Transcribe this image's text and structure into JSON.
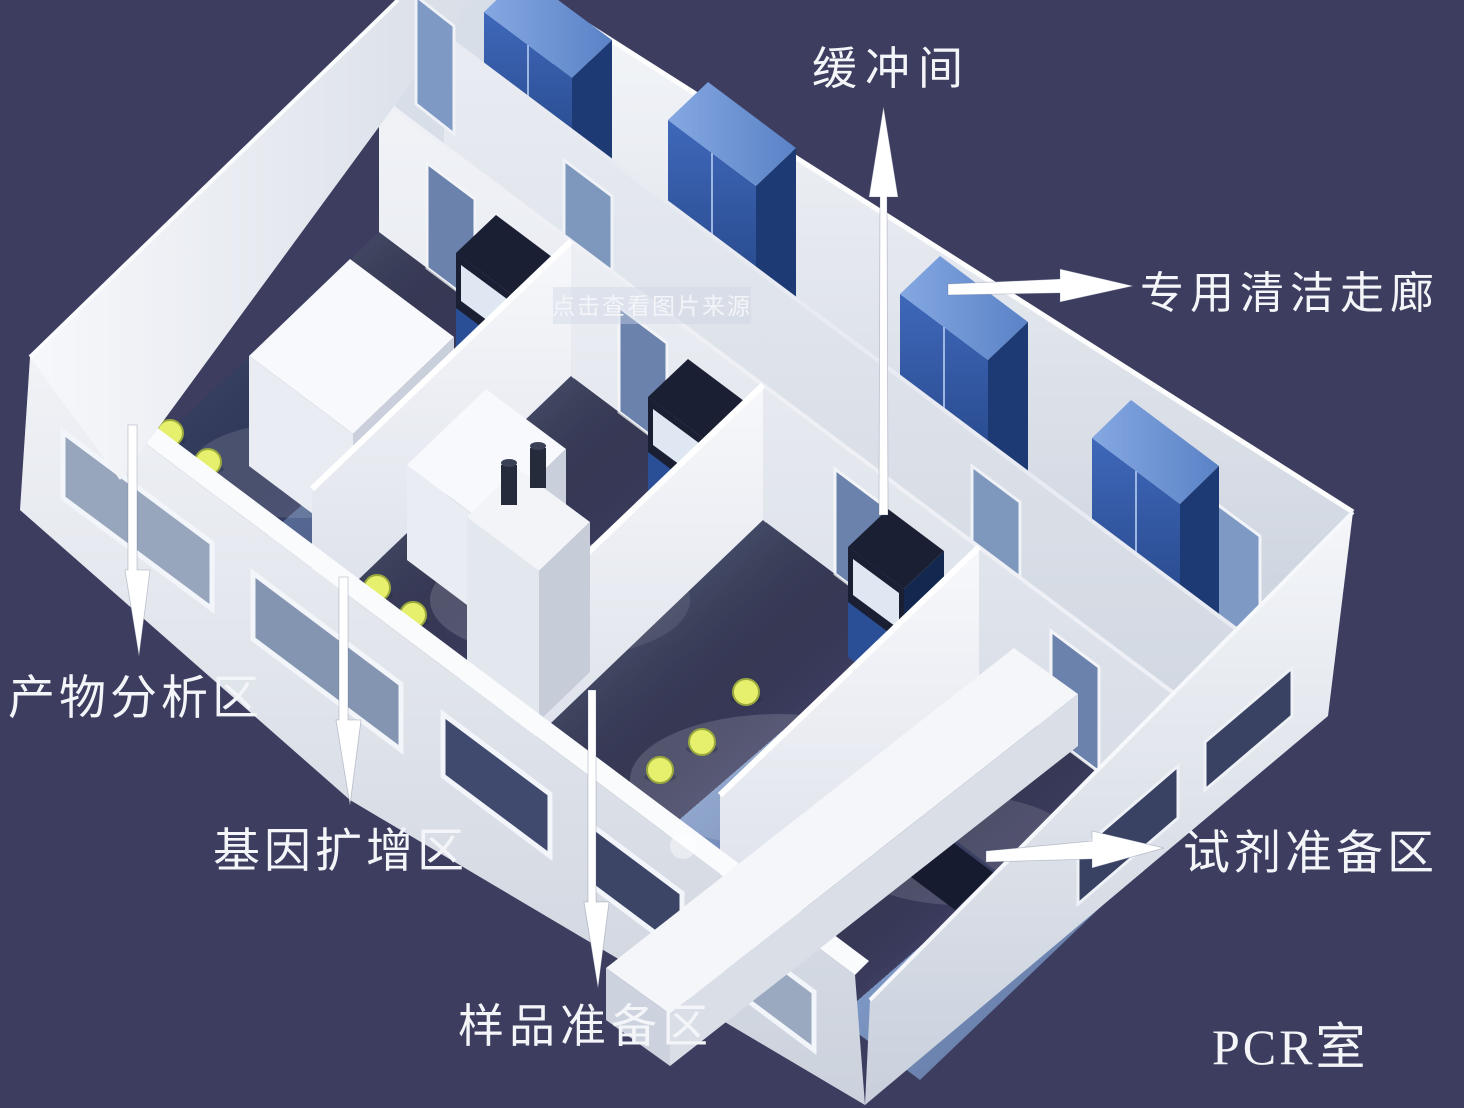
{
  "scene": {
    "description": "3D isometric cutaway diagram of a PCR laboratory suite with annotated functional zones",
    "title": "PCR室"
  },
  "labels": {
    "buffer_room": "缓冲间",
    "clean_corridor": "专用清洁走廊",
    "product_analysis": "产物分析区",
    "gene_amplification": "基因扩增区",
    "sample_preparation": "样品准备区",
    "reagent_preparation": "试剂准备区",
    "room_title": "PCR室"
  },
  "watermark": {
    "text": "点击查看图片来源"
  },
  "colors": {
    "background": "#3c3d5f",
    "wall_white": "#eef1f6",
    "floor_blue": "#7d97c4",
    "cabinet_blue": "#2e55a2",
    "stool_yellow": "#e6f06d",
    "label_text": "#f4f5f8",
    "watermark_text": "#4c5a7d"
  }
}
